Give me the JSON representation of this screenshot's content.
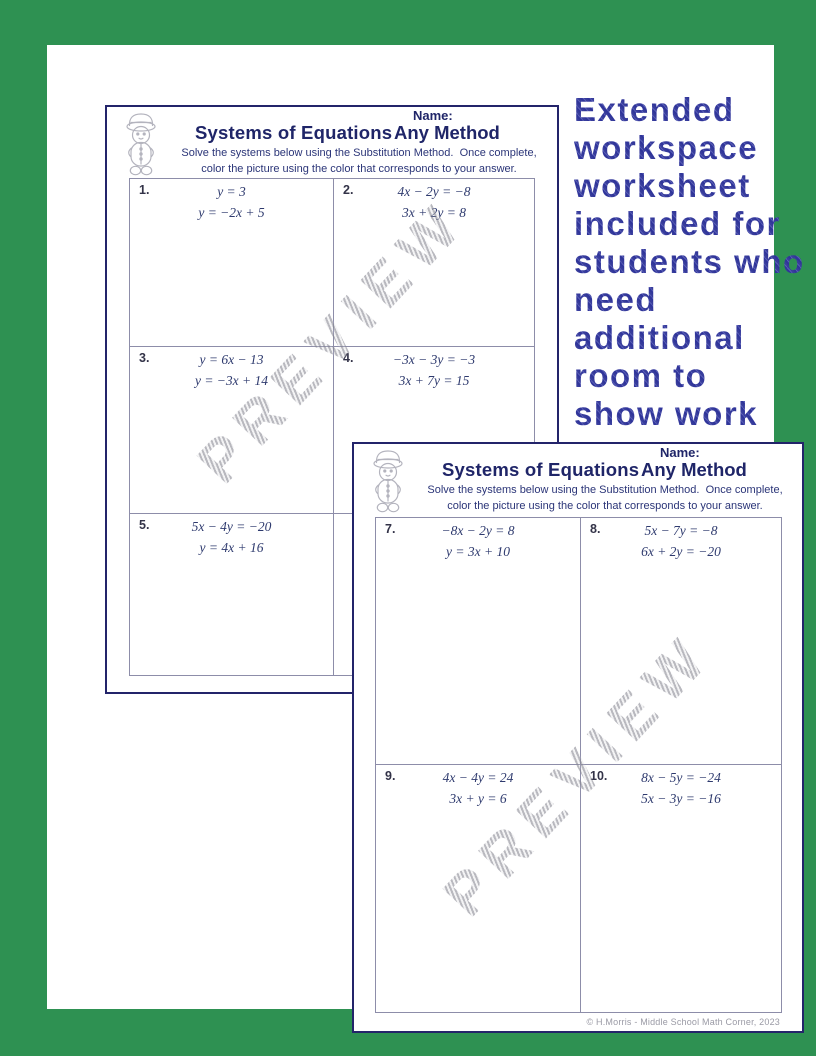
{
  "colors": {
    "background_green": "#2E9152",
    "paper_white": "#FFFFFF",
    "navy": "#1F2568",
    "annotation_blue": "#3B3F9E",
    "equation_blue": "#2E3A6E",
    "table_border_gray": "#8D8DA9",
    "watermark_gray": "#96969F"
  },
  "annotation": {
    "lines": [
      "Extended",
      "workspace",
      "worksheet",
      "included for",
      "students who",
      "need",
      "additional",
      "room to",
      "show work"
    ]
  },
  "watermark": {
    "text": "PREVIEW"
  },
  "sheets": [
    {
      "name_label": "Name:",
      "title": "Systems of Equations",
      "method": "Any Method",
      "instructions_line1": "Solve the systems below using the Substitution Method.  Once complete,",
      "instructions_line2": "color the picture using the color that corresponds to your answer.",
      "problems": [
        {
          "num": "1.",
          "eq1": "y = 3",
          "eq2": "y = −2x + 5"
        },
        {
          "num": "2.",
          "eq1": "4x − 2y = −8",
          "eq2": "3x + 2y = 8"
        },
        {
          "num": "3.",
          "eq1": "y = 6x − 13",
          "eq2": "y = −3x + 14"
        },
        {
          "num": "4.",
          "eq1": "−3x − 3y = −3",
          "eq2": "3x + 7y = 15"
        },
        {
          "num": "5.",
          "eq1": "5x − 4y = −20",
          "eq2": "y = 4x + 16"
        }
      ]
    },
    {
      "name_label": "Name:",
      "title": "Systems of Equations",
      "method": "Any Method",
      "instructions_line1": "Solve the systems below using the Substitution Method.  Once complete,",
      "instructions_line2": "color the picture using the color that corresponds to your answer.",
      "problems": [
        {
          "num": "7.",
          "eq1": "−8x − 2y = 8",
          "eq2": "y = 3x + 10"
        },
        {
          "num": "8.",
          "eq1": "5x − 7y = −8",
          "eq2": "6x + 2y = −20"
        },
        {
          "num": "9.",
          "eq1": "4x − 4y = 24",
          "eq2": "3x + y = 6"
        },
        {
          "num": "10.",
          "eq1": "8x − 5y = −24",
          "eq2": "5x − 3y = −16"
        }
      ],
      "footer": "© H.Morris - Middle School Math Corner, 2023"
    }
  ]
}
